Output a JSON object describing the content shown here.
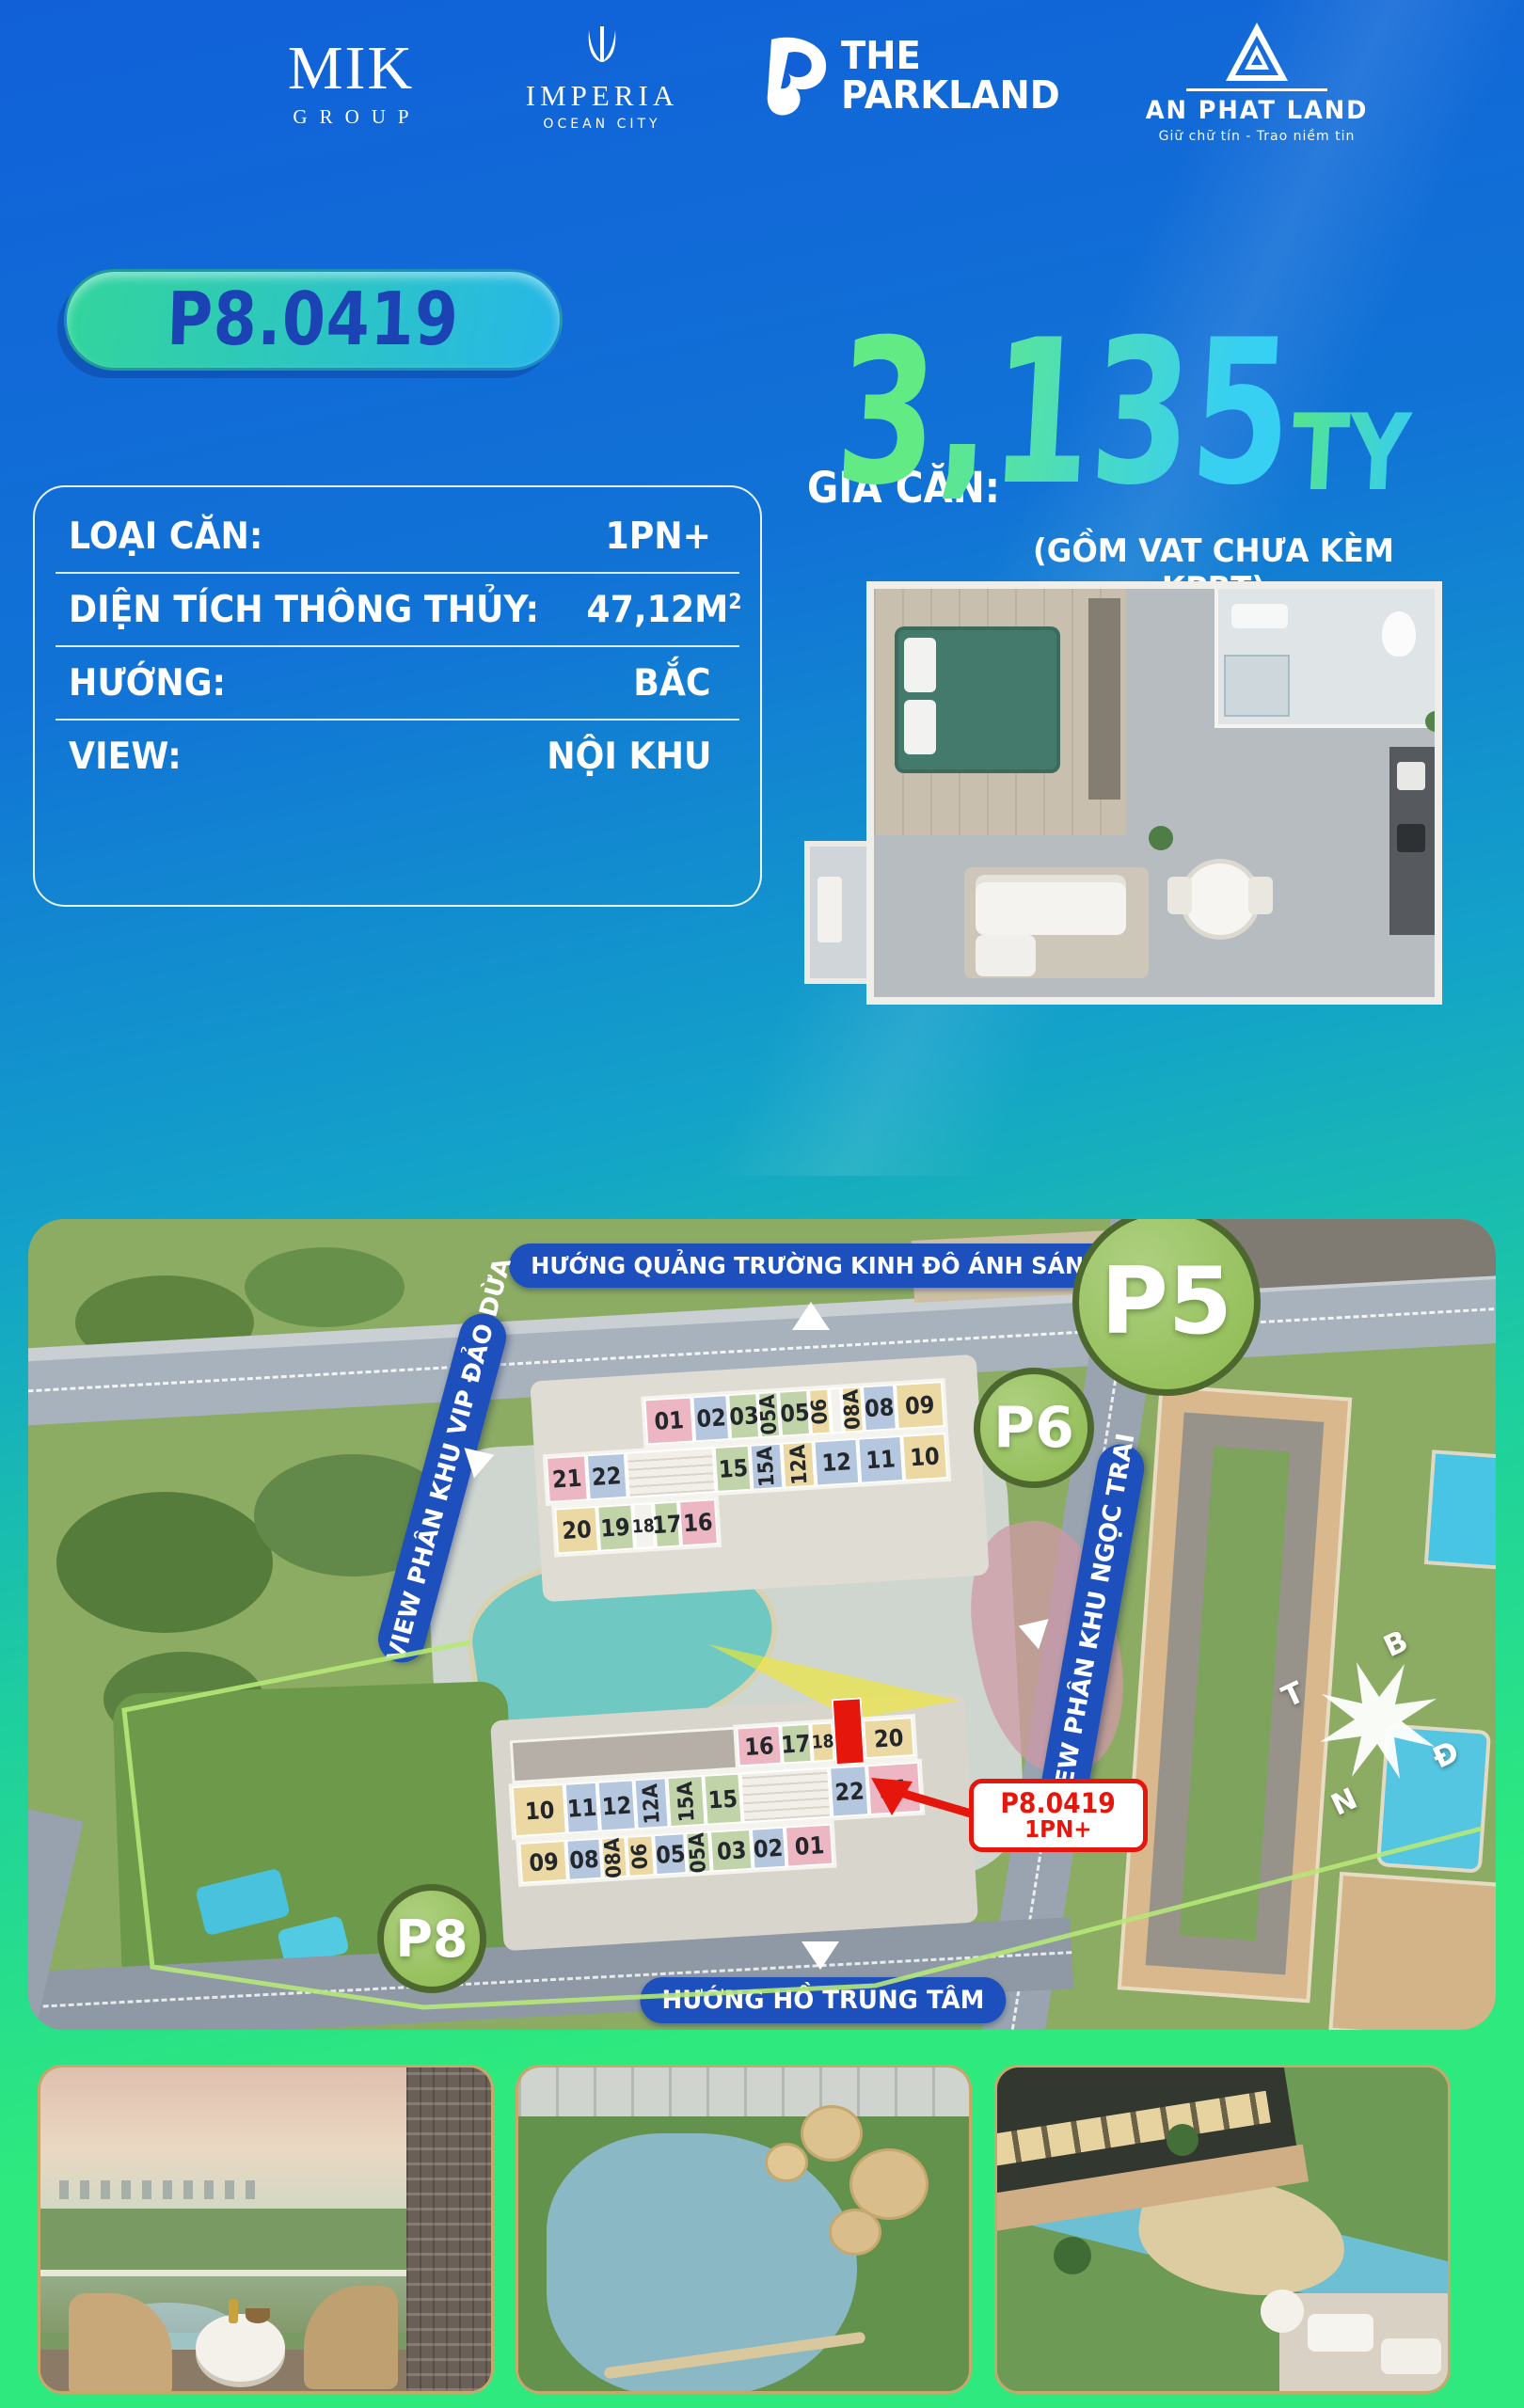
{
  "theme": {
    "bg_top": "#1160d8",
    "bg_mid": "#13a2c9",
    "bg_bot": "#2de97e",
    "badge_a": "#33d59b",
    "badge_b": "#27b7e8",
    "badge_text": "#1c43b4",
    "price_a": "#62ea84",
    "price_b": "#37cff2",
    "pill_blue": "#1d4fbd",
    "zone_a": "#aed081",
    "zone_b": "#8cba4e",
    "zone_border": "#4d682e",
    "red": "#e5170d",
    "gold": "#c9a76a"
  },
  "header": {
    "mik": {
      "name": "MIK",
      "sub": "GROUP"
    },
    "imperia": {
      "name": "IMPERIA",
      "sub": "OCEAN CITY"
    },
    "parkland": {
      "line1": "THE",
      "line2": "PARKLAND"
    },
    "anphat": {
      "name": "AN PHAT LAND",
      "tagline": "Giữ chữ tín  -  Trao niềm tin"
    }
  },
  "badge": {
    "label": "P8.0419"
  },
  "price": {
    "label": "GIÁ CĂN:",
    "value": "3,135",
    "unit": "TỶ",
    "note": "(GỒM VAT CHƯA KÈM KPBT)"
  },
  "details": {
    "rows": [
      {
        "label": "LOẠI CĂN:",
        "value": "1PN+",
        "sup": ""
      },
      {
        "label": "DIỆN TÍCH THÔNG THỦY:",
        "value": "47,12M",
        "sup": "2"
      },
      {
        "label": "HƯỚNG:",
        "value": "BẮC",
        "sup": ""
      },
      {
        "label": "VIEW:",
        "value": "NỘI KHU",
        "sup": ""
      }
    ]
  },
  "map": {
    "banners": {
      "top": "HƯỚNG QUẢNG TRƯỜNG KINH ĐÔ ÁNH SÁNG",
      "bottom": "HƯỚNG HỒ TRUNG TÂM",
      "left": "VIEW PHÂN KHU VIP ĐẢO DỪA",
      "right": "VIEW PHÂN KHU NGỌC TRAI"
    },
    "zones": {
      "p5": "P5",
      "p6": "P6",
      "p8": "P8"
    },
    "compass": {
      "n": "B",
      "e": "Đ",
      "s": "N",
      "w": "T"
    },
    "callout": {
      "code": "P8.0419",
      "type": "1PN+"
    },
    "building_p6": {
      "rows": [
        {
          "cells": [
            {
              "t": "01",
              "c": "pink",
              "w": 16
            },
            {
              "t": "02",
              "c": "blue",
              "w": 12
            },
            {
              "t": "03",
              "c": "green",
              "w": 10
            },
            {
              "t": "05A",
              "c": "green",
              "w": 7,
              "v": 1
            },
            {
              "t": "05",
              "c": "green",
              "w": 10
            },
            {
              "t": "06",
              "c": "yellow",
              "w": 7,
              "v": 1
            },
            {
              "t": "",
              "c": "white",
              "w": 4
            },
            {
              "t": "08A",
              "c": "yellow",
              "w": 7,
              "v": 1
            },
            {
              "t": "08",
              "c": "blue",
              "w": 11
            },
            {
              "t": "09",
              "c": "yellow",
              "w": 16
            }
          ]
        },
        {
          "cells": [
            {
              "t": "21",
              "c": "pink",
              "w": 10
            },
            {
              "t": "22",
              "c": "blue",
              "w": 10
            },
            {
              "t": "",
              "c": "core",
              "w": 22
            },
            {
              "t": "15",
              "c": "green",
              "w": 9
            },
            {
              "t": "15A",
              "c": "blue",
              "w": 8,
              "v": 1
            },
            {
              "t": "12A",
              "c": "yellow",
              "w": 8,
              "v": 1
            },
            {
              "t": "12",
              "c": "blue",
              "w": 11
            },
            {
              "t": "11",
              "c": "blue",
              "w": 11
            },
            {
              "t": "10",
              "c": "yellow",
              "w": 11
            }
          ]
        },
        {
          "cells": [
            {
              "t": "20",
              "c": "yellow",
              "w": 26
            },
            {
              "t": "19",
              "c": "green",
              "w": 22
            },
            {
              "t": "18",
              "c": "white",
              "w": 13,
              "s": 1
            },
            {
              "t": "17",
              "c": "green",
              "w": 16
            },
            {
              "t": "16",
              "c": "pink",
              "w": 23
            }
          ]
        }
      ]
    },
    "building_p8": {
      "rows": [
        {
          "cells": [
            {
              "t": "16",
              "c": "pink",
              "w": 25
            },
            {
              "t": "17",
              "c": "green",
              "w": 17
            },
            {
              "t": "18",
              "c": "yellow",
              "w": 13,
              "s": 1
            },
            {
              "t": "",
              "c": "red",
              "w": 17
            },
            {
              "t": "20",
              "c": "yellow",
              "w": 28
            }
          ]
        },
        {
          "cells": [
            {
              "t": "10",
              "c": "yellow",
              "w": 13
            },
            {
              "t": "11",
              "c": "blue",
              "w": 8
            },
            {
              "t": "12",
              "c": "blue",
              "w": 9
            },
            {
              "t": "12A",
              "c": "blue",
              "w": 8,
              "v": 1
            },
            {
              "t": "15A",
              "c": "green",
              "w": 9,
              "v": 1
            },
            {
              "t": "15",
              "c": "green",
              "w": 9
            },
            {
              "t": "",
              "c": "core",
              "w": 22
            },
            {
              "t": "22",
              "c": "blue",
              "w": 9
            },
            {
              "t": "21",
              "c": "pink",
              "w": 13
            }
          ]
        },
        {
          "cells": [
            {
              "t": "09",
              "c": "yellow",
              "w": 15
            },
            {
              "t": "08",
              "c": "blue",
              "w": 11
            },
            {
              "t": "08A",
              "c": "yellow",
              "w": 8,
              "v": 1
            },
            {
              "t": "06",
              "c": "yellow",
              "w": 9,
              "v": 1
            },
            {
              "t": "05",
              "c": "blue",
              "w": 10
            },
            {
              "t": "05A",
              "c": "green",
              "w": 8,
              "v": 1
            },
            {
              "t": "03",
              "c": "green",
              "w": 13
            },
            {
              "t": "02",
              "c": "blue",
              "w": 11
            },
            {
              "t": "01",
              "c": "pink",
              "w": 15
            }
          ]
        }
      ]
    }
  },
  "photos": [
    {
      "name": "balcony-city-view"
    },
    {
      "name": "aerial-lake-park-view"
    },
    {
      "name": "resort-pool-courtyard-view"
    }
  ]
}
